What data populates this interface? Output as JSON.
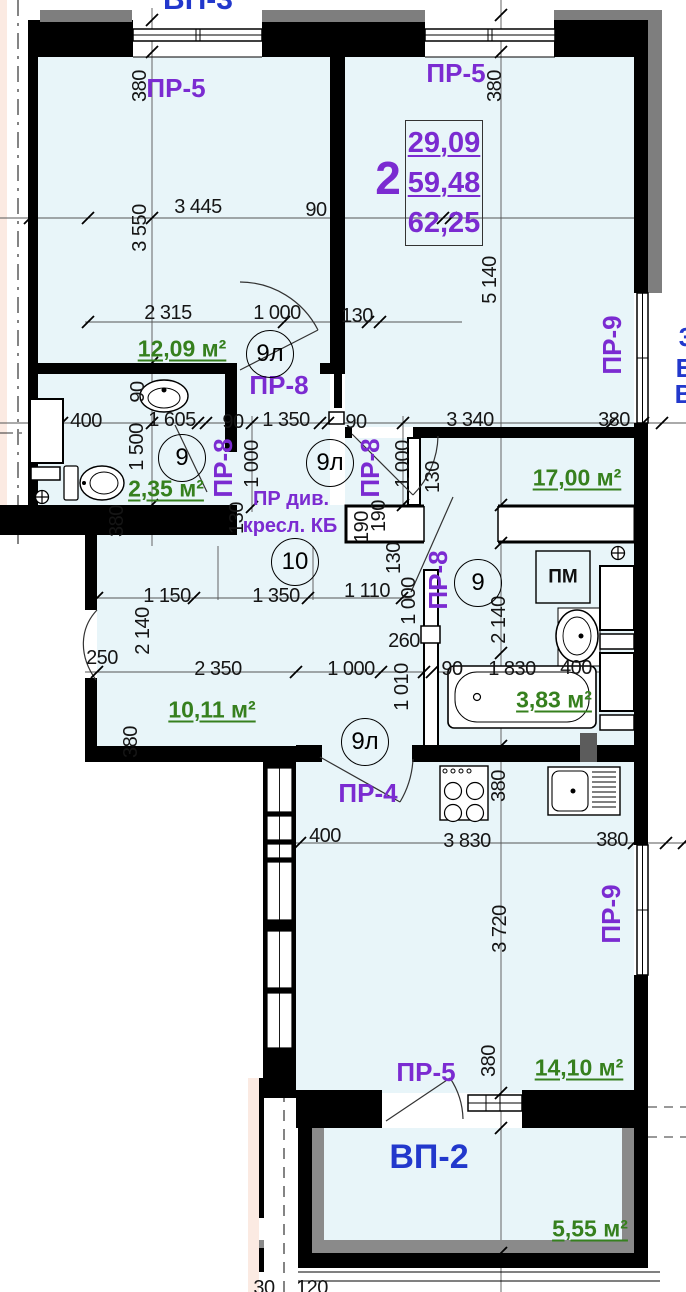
{
  "apartment_info": {
    "number": "2",
    "area_living": "29,09",
    "area_total": "59,48",
    "area_overall": "62,25"
  },
  "colors": {
    "room_fill": "#e8f5f9",
    "wall": "#000000",
    "exterior_gray": "#7e7e7e",
    "outside_pink": "#fbeae2",
    "opening_label": "#7b2bd1",
    "balcony_label": "#2238cc",
    "area_label": "#36801e",
    "dimension_text": "#151515"
  },
  "labels": {
    "dimensions": {
      "style": "dim",
      "items": [
        {
          "t": "3 445",
          "x": 198,
          "y": 207
        },
        {
          "t": "90",
          "x": 316,
          "y": 210
        },
        {
          "t": "380",
          "x": 140,
          "y": 86,
          "r": -90
        },
        {
          "t": "3 550",
          "x": 140,
          "y": 228,
          "r": -90
        },
        {
          "t": "380",
          "x": 495,
          "y": 86,
          "r": -90
        },
        {
          "t": "5 140",
          "x": 490,
          "y": 280,
          "r": -90
        },
        {
          "t": "2 315",
          "x": 168,
          "y": 313
        },
        {
          "t": "1 000",
          "x": 277,
          "y": 313
        },
        {
          "t": "130",
          "x": 357,
          "y": 316
        },
        {
          "t": "400",
          "x": 86,
          "y": 421
        },
        {
          "t": "1 605",
          "x": 172,
          "y": 420
        },
        {
          "t": "90",
          "x": 233,
          "y": 422
        },
        {
          "t": "1 350",
          "x": 286,
          "y": 420
        },
        {
          "t": "90",
          "x": 356,
          "y": 422
        },
        {
          "t": "3 340",
          "x": 470,
          "y": 420
        },
        {
          "t": "380",
          "x": 614,
          "y": 420
        },
        {
          "t": "90",
          "x": 138,
          "y": 392,
          "r": -90
        },
        {
          "t": "1 500",
          "x": 137,
          "y": 447,
          "r": -90
        },
        {
          "t": "1 000",
          "x": 252,
          "y": 464,
          "r": -90
        },
        {
          "t": "1 000",
          "x": 403,
          "y": 464,
          "r": -90
        },
        {
          "t": "130",
          "x": 433,
          "y": 477,
          "r": -90
        },
        {
          "t": "380",
          "x": 117,
          "y": 521,
          "r": -90
        },
        {
          "t": "130",
          "x": 237,
          "y": 518,
          "r": -90
        },
        {
          "t": "190",
          "x": 362,
          "y": 527,
          "r": -90
        },
        {
          "t": "190",
          "x": 379,
          "y": 516,
          "r": -90
        },
        {
          "t": "130",
          "x": 394,
          "y": 558,
          "r": -90
        },
        {
          "t": "1 000",
          "x": 409,
          "y": 601,
          "r": -90
        },
        {
          "t": "1 150",
          "x": 167,
          "y": 596
        },
        {
          "t": "1 350",
          "x": 276,
          "y": 596
        },
        {
          "t": "1 110",
          "x": 367,
          "y": 591
        },
        {
          "t": "250",
          "x": 102,
          "y": 658
        },
        {
          "t": "2 140",
          "x": 143,
          "y": 631,
          "r": -90
        },
        {
          "t": "2 140",
          "x": 499,
          "y": 620,
          "r": -90
        },
        {
          "t": "260",
          "x": 404,
          "y": 641
        },
        {
          "t": "2 350",
          "x": 218,
          "y": 669
        },
        {
          "t": "1 000",
          "x": 351,
          "y": 669
        },
        {
          "t": "90",
          "x": 452,
          "y": 669
        },
        {
          "t": "1 830",
          "x": 512,
          "y": 669
        },
        {
          "t": "400",
          "x": 576,
          "y": 668
        },
        {
          "t": "1 010",
          "x": 402,
          "y": 687,
          "r": -90
        },
        {
          "t": "380",
          "x": 131,
          "y": 742,
          "r": -90
        },
        {
          "t": "380",
          "x": 499,
          "y": 786,
          "r": -90
        },
        {
          "t": "400",
          "x": 325,
          "y": 836
        },
        {
          "t": "3 830",
          "x": 467,
          "y": 841
        },
        {
          "t": "380",
          "x": 612,
          "y": 840
        },
        {
          "t": "3 720",
          "x": 500,
          "y": 929,
          "r": -90
        },
        {
          "t": "380",
          "x": 489,
          "y": 1061,
          "r": -90
        },
        {
          "t": "30",
          "x": 264,
          "y": 1288
        },
        {
          "t": "120",
          "x": 312,
          "y": 1288
        }
      ]
    },
    "openings": {
      "style": "opening",
      "items": [
        {
          "t": "ПР-5",
          "x": 176,
          "y": 88
        },
        {
          "t": "ПР-5",
          "x": 456,
          "y": 73
        },
        {
          "t": "ПР-8",
          "x": 279,
          "y": 385
        },
        {
          "t": "ПР-8",
          "x": 223,
          "y": 468,
          "r": -90
        },
        {
          "t": "ПР-8",
          "x": 370,
          "y": 468,
          "r": -90
        },
        {
          "t": "ПР-8",
          "x": 438,
          "y": 580,
          "r": -90
        },
        {
          "t": "ПР-9",
          "x": 612,
          "y": 345,
          "r": -90
        },
        {
          "t": "ПР-4",
          "x": 368,
          "y": 793
        },
        {
          "t": "ПР-9",
          "x": 611,
          "y": 914,
          "r": -90
        },
        {
          "t": "ПР-5",
          "x": 426,
          "y": 1072
        }
      ]
    },
    "areas": {
      "style": "area",
      "items": [
        {
          "t": "12,09 м²",
          "x": 182,
          "y": 349
        },
        {
          "t": "2,35 м²",
          "x": 166,
          "y": 489
        },
        {
          "t": "17,00 м²",
          "x": 577,
          "y": 478
        },
        {
          "t": "10,11 м²",
          "x": 212,
          "y": 710
        },
        {
          "t": "3,83 м²",
          "x": 554,
          "y": 700
        },
        {
          "t": "14,10 м²",
          "x": 579,
          "y": 1068
        },
        {
          "t": "5,55 м²",
          "x": 590,
          "y": 1229
        }
      ]
    },
    "doors": {
      "style": "door-circle",
      "items": [
        {
          "t": "9л",
          "x": 270,
          "y": 354
        },
        {
          "t": "9",
          "x": 182,
          "y": 458
        },
        {
          "t": "9л",
          "x": 330,
          "y": 463
        },
        {
          "t": "10",
          "x": 295,
          "y": 562
        },
        {
          "t": "9",
          "x": 478,
          "y": 583
        },
        {
          "t": "9л",
          "x": 365,
          "y": 742
        }
      ]
    },
    "balconies": {
      "style": "balcony",
      "items": [
        {
          "t": "ВП-3",
          "x": 198,
          "y": 0,
          "fs": 30
        },
        {
          "t": "ВП-2",
          "x": 429,
          "y": 1157,
          "fs": 34
        }
      ]
    },
    "notes": {
      "style": "note",
      "items": [
        {
          "t": "ПР див.",
          "x": 291,
          "y": 499
        },
        {
          "t": "кресл. КБ",
          "x": 290,
          "y": 526
        }
      ]
    },
    "fixture_labels": {
      "style": "fixture",
      "items": [
        {
          "t": "ПМ",
          "x": 563,
          "y": 577
        }
      ]
    },
    "edge_fragments": {
      "style": "fragment",
      "items": [
        {
          "t": "3",
          "x": 686,
          "y": 337
        },
        {
          "t": "Б",
          "x": 685,
          "y": 368
        },
        {
          "t": "В",
          "x": 684,
          "y": 394
        }
      ]
    }
  }
}
